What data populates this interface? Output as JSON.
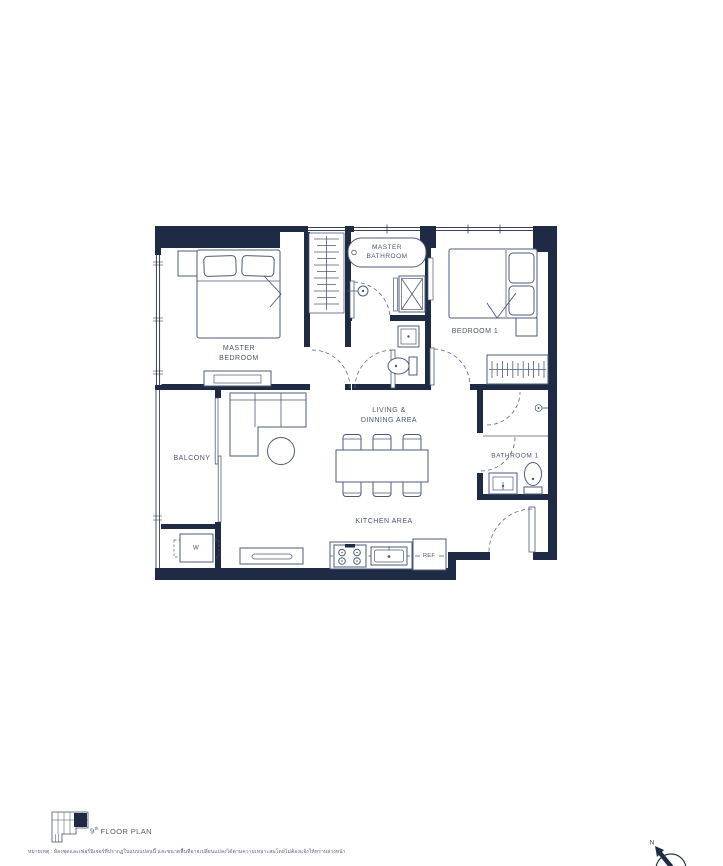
{
  "colors": {
    "wall": "#1f2a44",
    "furniture_line": "#4d5b7a",
    "door_line": "#5a6886",
    "text": "#4a566f",
    "background": "#ffffff"
  },
  "rooms": {
    "master_bedroom": {
      "line1": "MASTER",
      "line2": "BEDROOM"
    },
    "master_bathroom": {
      "line1": "MASTER",
      "line2": "BATHROOM"
    },
    "bedroom_1": {
      "label": "BEDROOM 1"
    },
    "bathroom_1": {
      "label": "BATHROOM 1"
    },
    "living_dining": {
      "line1": "LIVING &",
      "line2": "DINNING AREA"
    },
    "kitchen": {
      "label": "KITCHEN AREA"
    },
    "balcony": {
      "label": "BALCONY"
    }
  },
  "fixtures": {
    "washer_label": "W",
    "fridge_label": "REF"
  },
  "footer": {
    "floor_number": "9",
    "floor_ordinal": "th",
    "floor_text": "FLOOR PLAN",
    "disclaimer": "หมายเหตุ : ห้องชุดและเฟอร์นิเจอร์ที่ปรากฏในแบบแปลนนี้ และขนาดพื้นที่อาจเปลี่ยนแปลงได้ตามความเหมาะสมโดยไม่ต้องแจ้งให้ทราบล่วงหน้า"
  },
  "compass": {
    "north_label": "N"
  }
}
